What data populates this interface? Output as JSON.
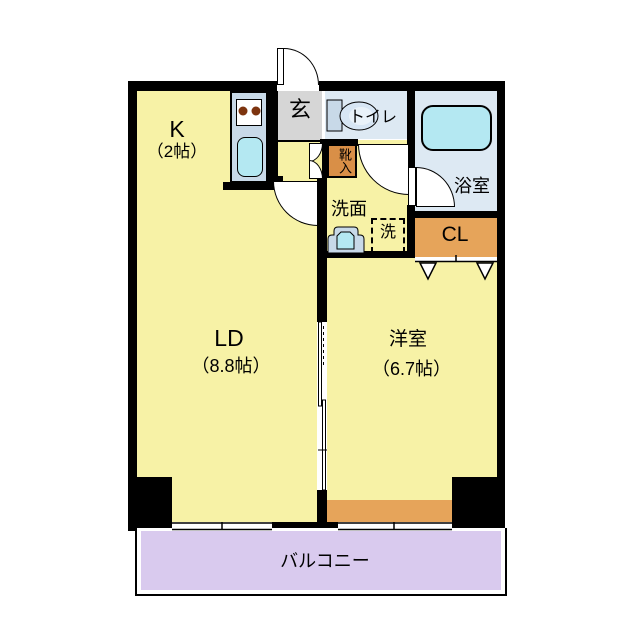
{
  "title": "1LDK apartment floor plan",
  "colors": {
    "wall": "#000000",
    "room_yellow": "#f7f2a6",
    "genkan_gray": "#d6d6d6",
    "wet_area_blue": "#dde9f3",
    "fixture_cyan": "#b4e8f2",
    "cabinet_blue": "#c8d9e8",
    "closet_orange": "#e6a45a",
    "shoe_cabinet_orange": "#d98f47",
    "balcony_lavender": "#d9caee",
    "burner_brown": "#7d340f"
  },
  "rooms": {
    "kitchen": {
      "label": "K",
      "size": "（2帖）"
    },
    "living_dining": {
      "label": "LD",
      "size": "（8.8帖）"
    },
    "western_room": {
      "label": "洋室",
      "size": "（6.7帖）"
    },
    "entrance": {
      "label": "玄"
    },
    "toilet": {
      "label": "トイレ"
    },
    "bathroom": {
      "label": "浴室"
    },
    "washroom": {
      "label": "洗面"
    },
    "washing_machine": {
      "label": "洗"
    },
    "shoe_cabinet": {
      "label": "靴入"
    },
    "closet": {
      "label": "CL"
    },
    "balcony": {
      "label": "バルコニー"
    }
  }
}
